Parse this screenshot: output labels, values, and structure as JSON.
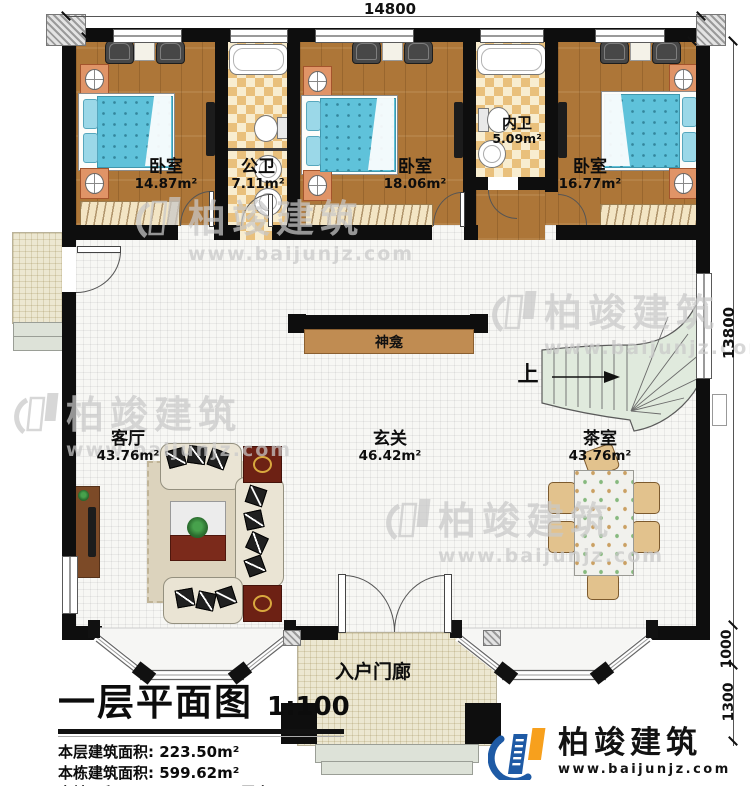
{
  "dimensions": {
    "width_top": "14800",
    "height_right": "13800",
    "right_upper": "1000",
    "right_lower": "1300"
  },
  "rooms": {
    "bedroom1": {
      "name": "卧室",
      "area": "14.87m²"
    },
    "public_bath": {
      "name": "公卫",
      "area": "7.11m²"
    },
    "bedroom2": {
      "name": "卧室",
      "area": "18.06m²"
    },
    "inner_bath": {
      "name": "内卫",
      "area": "5.09m²"
    },
    "bedroom3": {
      "name": "卧室",
      "area": "16.77m²"
    },
    "foyer": {
      "name": "玄关",
      "area": "46.42m²"
    },
    "living_room": {
      "name": "客厅",
      "area": "43.76m²"
    },
    "tea_room": {
      "name": "茶室",
      "area": "43.76m²"
    },
    "entry_porch": {
      "name": "入户门廊"
    },
    "shrine": {
      "name": "神龛"
    },
    "stair_direction": "上"
  },
  "title_block": {
    "title": "一层平面图",
    "scale": "1:100",
    "stat1": "本层建筑面积: 223.50m²",
    "stat2": "本栋建筑面积: 599.62m²",
    "stat3": "占地面积: 229.80m²",
    "stat4": "层高: 3.9m"
  },
  "brand": {
    "name": "柏竣建筑",
    "url": "www.baijunjz.com",
    "primary_color": "#1e5aa5",
    "accent_color": "#f7a01d"
  },
  "watermark": {
    "name": "柏竣建筑",
    "url": "www.baijunjz.com"
  }
}
